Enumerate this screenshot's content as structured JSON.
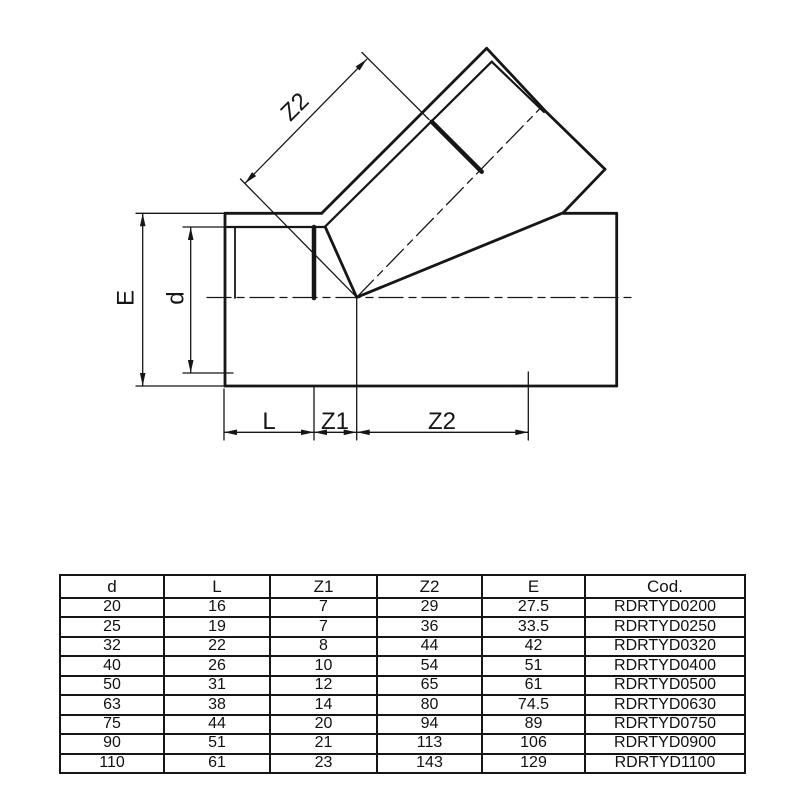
{
  "colors": {
    "line": "#161616",
    "background": "#ffffff"
  },
  "drawing": {
    "dim_E": "E",
    "dim_d": "d",
    "dim_Z2_branch": "Z2",
    "dim_L": "L",
    "dim_Z1": "Z1",
    "dim_Z2_run": "Z2"
  },
  "table": {
    "headers": [
      "d",
      "L",
      "Z1",
      "Z2",
      "E",
      "Cod."
    ],
    "rows": [
      [
        "20",
        "16",
        "7",
        "29",
        "27.5",
        "RDRTYD0200"
      ],
      [
        "25",
        "19",
        "7",
        "36",
        "33.5",
        "RDRTYD0250"
      ],
      [
        "32",
        "22",
        "8",
        "44",
        "42",
        "RDRTYD0320"
      ],
      [
        "40",
        "26",
        "10",
        "54",
        "51",
        "RDRTYD0400"
      ],
      [
        "50",
        "31",
        "12",
        "65",
        "61",
        "RDRTYD0500"
      ],
      [
        "63",
        "38",
        "14",
        "80",
        "74.5",
        "RDRTYD0630"
      ],
      [
        "75",
        "44",
        "20",
        "94",
        "89",
        "RDRTYD0750"
      ],
      [
        "90",
        "51",
        "21",
        "113",
        "106",
        "RDRTYD0900"
      ],
      [
        "110",
        "61",
        "23",
        "143",
        "129",
        "RDRTYD1100"
      ]
    ]
  }
}
